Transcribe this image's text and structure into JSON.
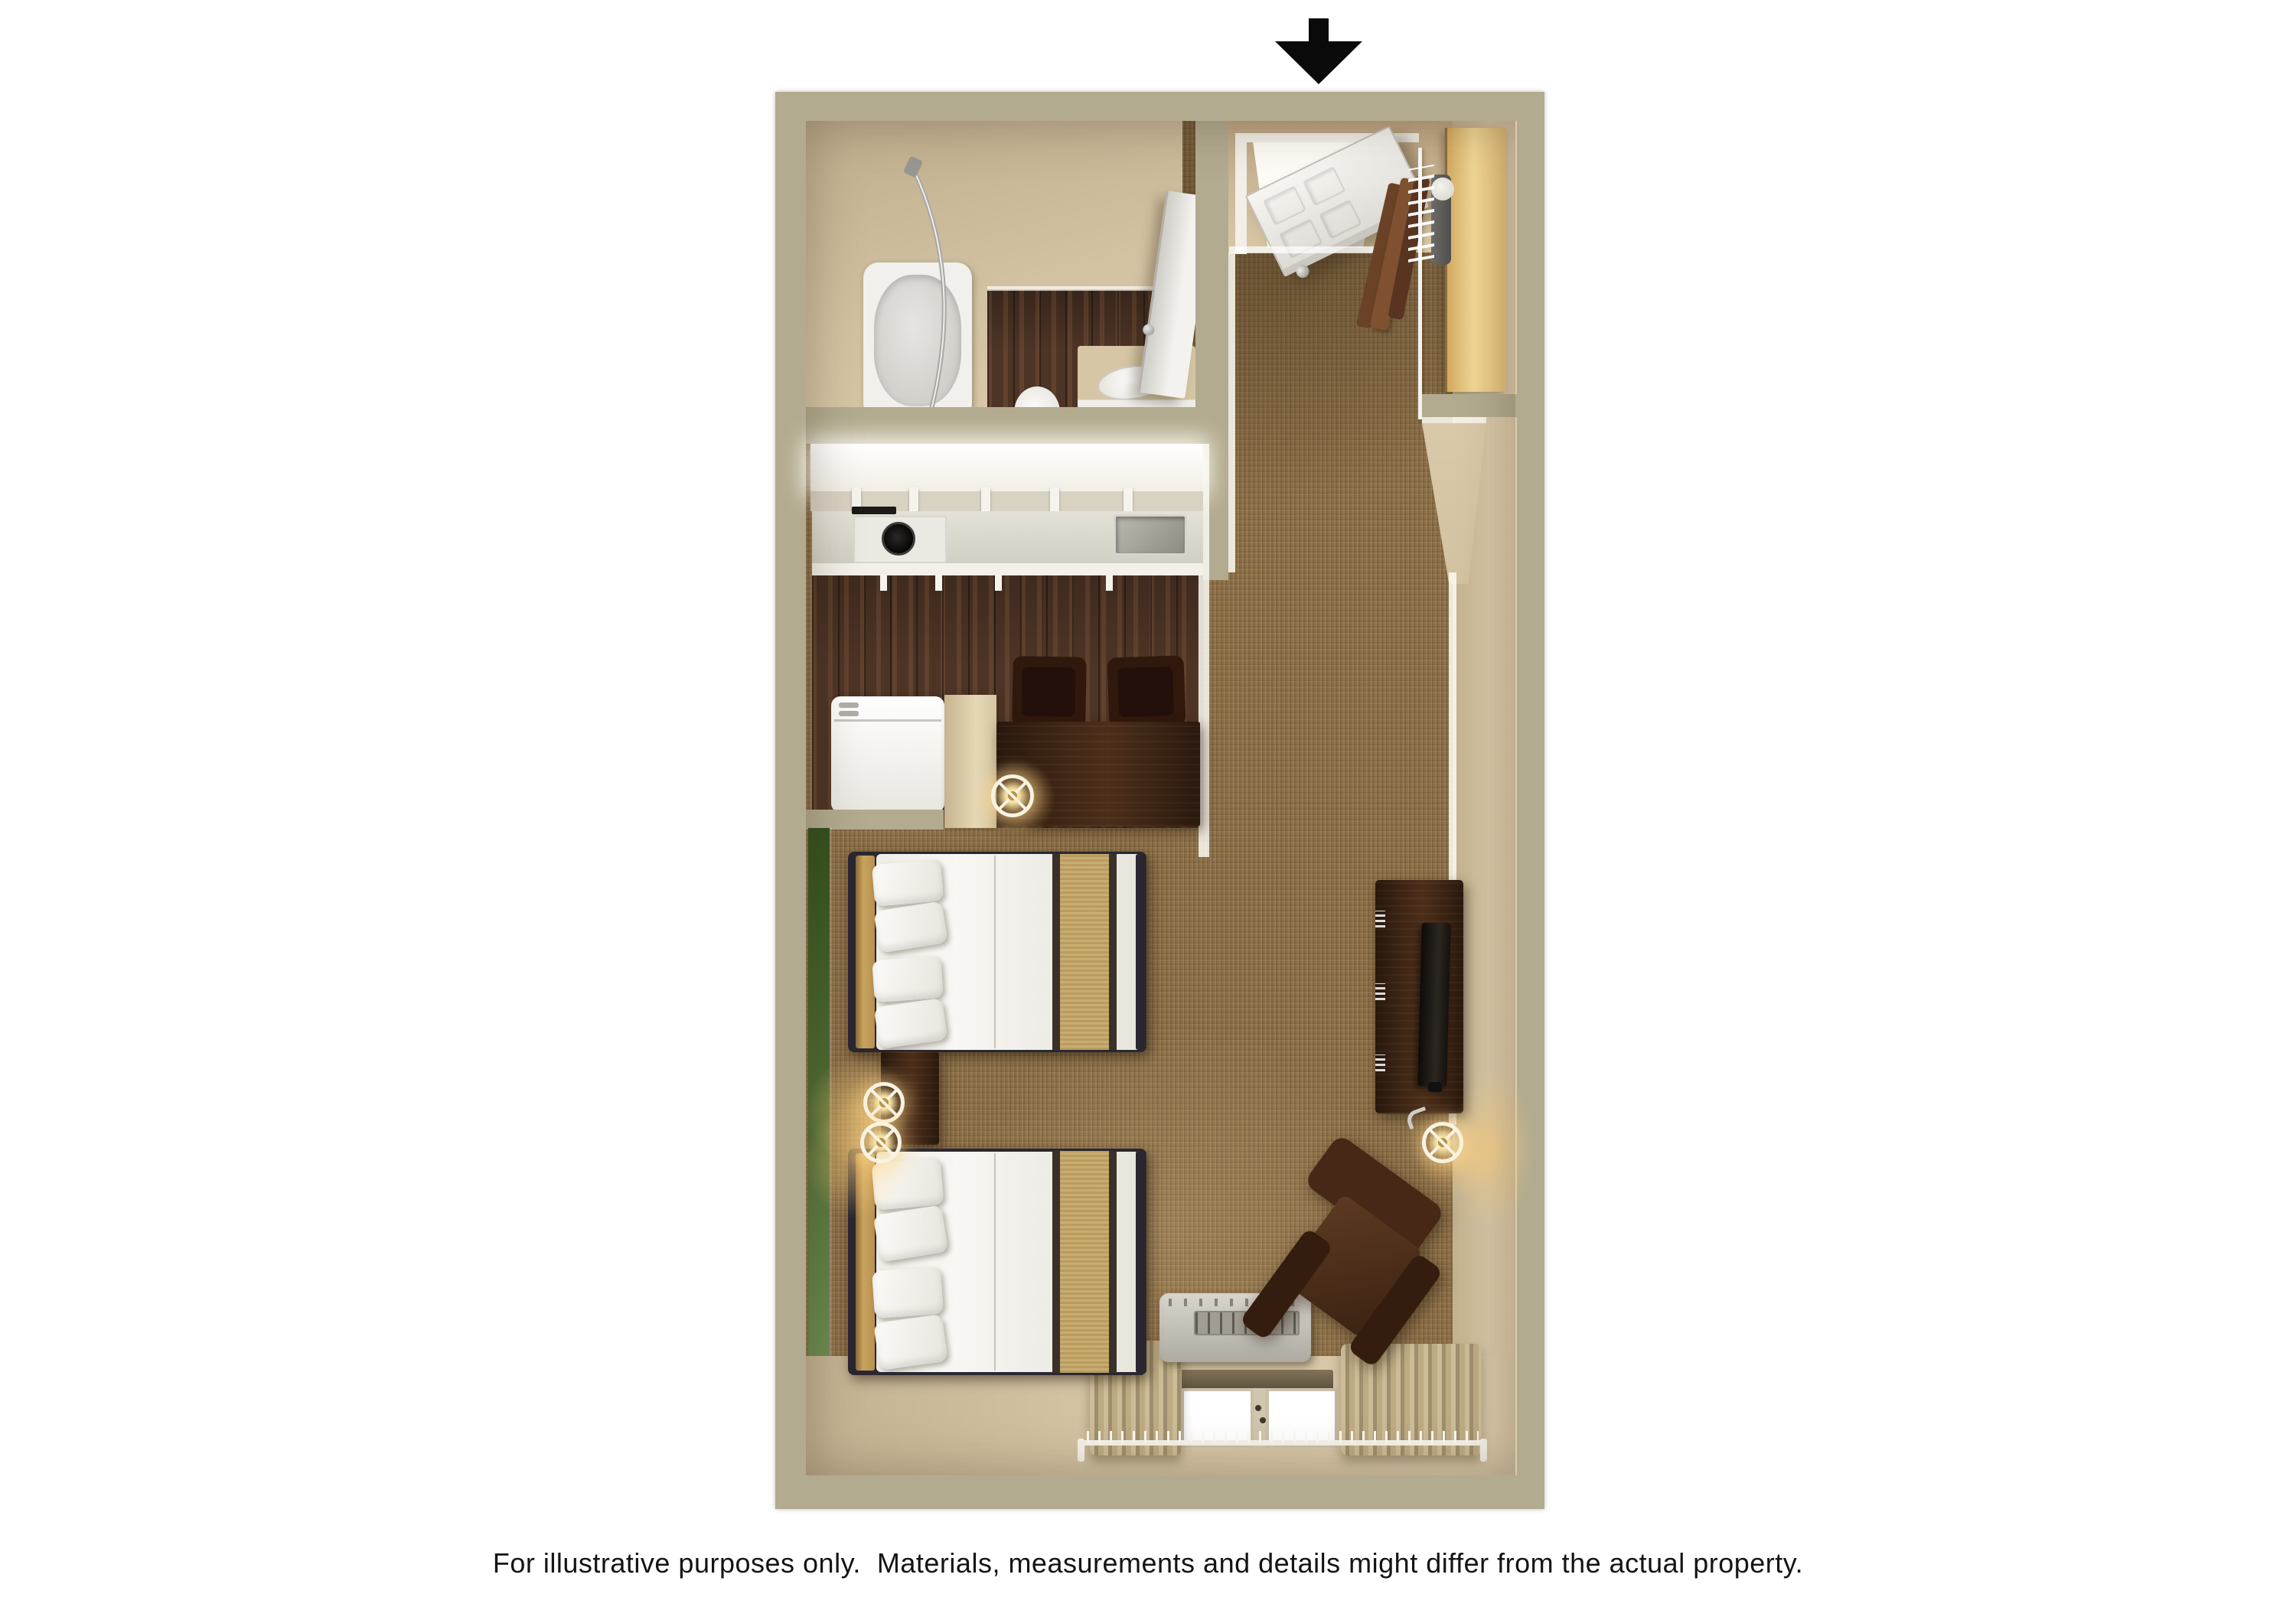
{
  "caption": {
    "text": "For illustrative purposes only.  Materials, measurements and details might differ from the actual property."
  },
  "entrance_arrow": {
    "icon": "arrow-down",
    "color": "#0a0a0a"
  },
  "palette": {
    "page_bg": "#ffffff",
    "outer_wall": "#b2ab8f",
    "wall_face": "#d0be9e",
    "wall_face_bright": "#dccbaa",
    "carpet": "#8b6e46",
    "wood_floor": "#4e3425",
    "green_accent": "#4e6b33",
    "cabinet_white": "#f7f5ee",
    "counter": "#d9d6cb",
    "furniture_wood": "#3d2414",
    "leather_brown": "#4a2a18",
    "bed_linen": "#f2f0ea",
    "bed_runner": "#c9ac70",
    "headboard_tan": "#c59f5e",
    "closet_wood": "#e9c886",
    "curtain_tan": "#b4a47e",
    "lamp_glow": "#ffd27d",
    "tv_black": "#17110d"
  },
  "items": [
    "entrance-door",
    "closet-rod-with-hangers",
    "closet-shelf",
    "bathtub-with-shower-rod",
    "toilet",
    "vanity-sink",
    "bathroom-door",
    "upper-cabinets",
    "cooktop",
    "kitchen-sink",
    "refrigerator",
    "dining-desk",
    "two-dining-chairs",
    "desk-lamp",
    "bed-1",
    "bed-2",
    "nightstand",
    "two-nightstand-lamps",
    "tv-on-dresser",
    "floor-lamp",
    "armchair",
    "air-conditioner-unit",
    "window-with-curtains",
    "green-accent-wall"
  ]
}
